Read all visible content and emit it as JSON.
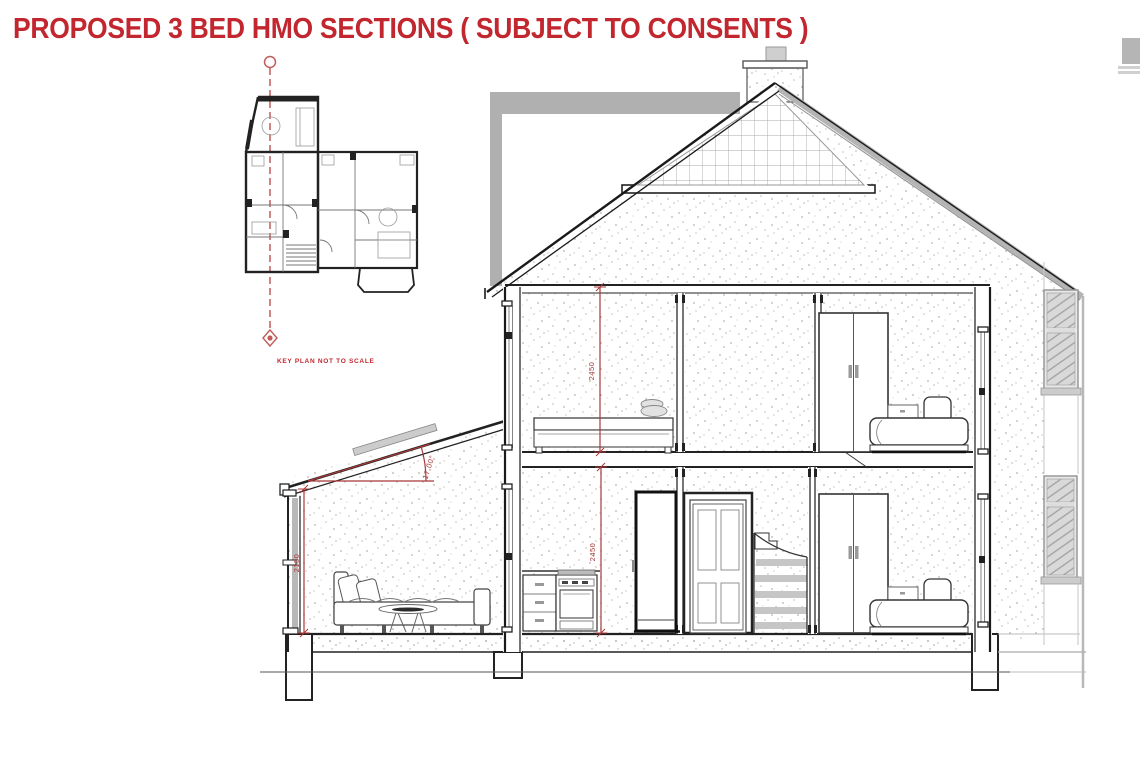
{
  "page": {
    "width": 1140,
    "height": 759,
    "background": "#ffffff"
  },
  "title": {
    "text": "PROPOSED 3 BED HMO SECTIONS ( SUBJECT TO CONSENTS )",
    "color": "#c2262e"
  },
  "key_plan": {
    "label": "KEY PLAN NOT TO SCALE",
    "section_line_color": "#c25b5b",
    "markers": [
      "section-cut-circle-top",
      "section-cut-diamond-bottom"
    ]
  },
  "section": {
    "dimensions": {
      "first_floor_room_height": "2450",
      "ground_floor_room_height": "2450",
      "extension_room_height": "2150",
      "extension_roof_angle": "17.00°"
    },
    "colors": {
      "dimension_red": "#a83838",
      "line_black": "#1a1a1a",
      "background_gray": "#b0b0b0",
      "stipple_gray": "#b8b1a7"
    },
    "elements": [
      "pitched roof with brick gable",
      "chimney",
      "neighbouring building outline",
      "first-floor bedroom with single bed",
      "first-floor landing",
      "first-floor bedroom with wardrobe and double bed",
      "ground-floor kitchen with drawers, cooker and tall fridge unit",
      "glazed four-panel door",
      "staircase",
      "ground-floor bedroom with wardrobe and double bed",
      "single-storey rear extension with sofa and coffee table",
      "side elevation windows",
      "foundations and ground slab"
    ]
  }
}
